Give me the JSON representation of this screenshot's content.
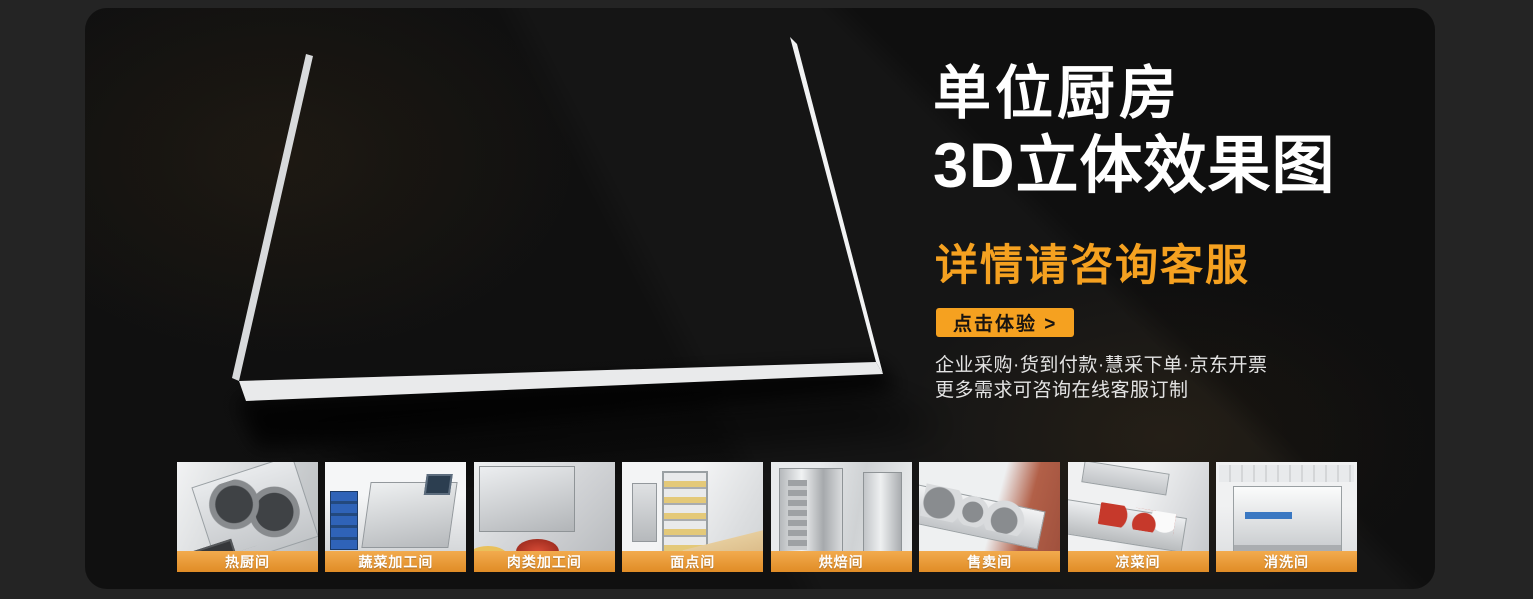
{
  "hero": {
    "title_line1": "单位厨房",
    "title_line2": "3D立体效果图",
    "subtitle": "详情请咨询客服",
    "cta_label": "点击体验 >",
    "note_line1": "企业采购·货到付款·慧采下单·京东开票",
    "note_line2": "更多需求可咨询在线客服订制"
  },
  "colors": {
    "page_bg": "#242424",
    "panel_bg": "#151515",
    "accent": "#F5A120",
    "caption_top": "#F2AB4E",
    "caption_bottom": "#E08C26",
    "title_color": "#FFFFFF",
    "note_color": "#E3E3E3",
    "cta_text_color": "#181411"
  },
  "floorplan": {
    "description": "3D isometric floor plan of an institutional kitchen"
  },
  "thumbnails": [
    {
      "label": "热厨间"
    },
    {
      "label": "蔬菜加工间"
    },
    {
      "label": "肉类加工间"
    },
    {
      "label": "面点间"
    },
    {
      "label": "烘焙间"
    },
    {
      "label": "售卖间"
    },
    {
      "label": "凉菜间"
    },
    {
      "label": "消洗间"
    }
  ]
}
